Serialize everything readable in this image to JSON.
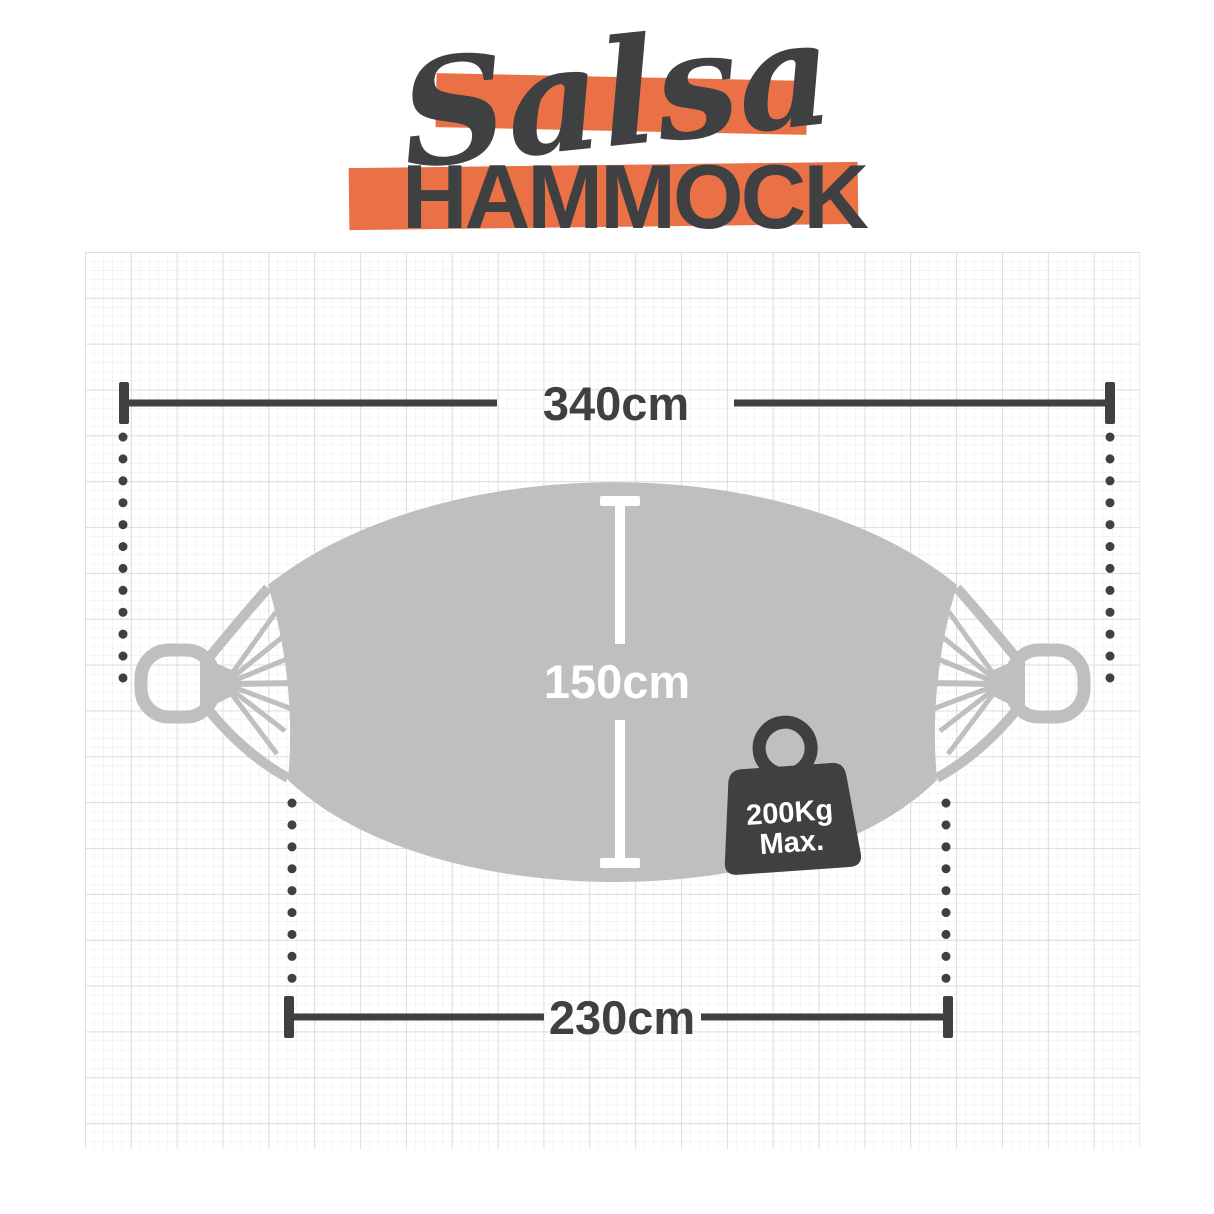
{
  "title": {
    "script": "Salsa",
    "main": "HAMMOCK"
  },
  "dimensions": {
    "total_length": "340cm",
    "width": "150cm",
    "bed_length": "230cm"
  },
  "weight_limit": {
    "line1": "200Kg",
    "line2": "Max."
  },
  "colors": {
    "accent_orange": "#EA7146",
    "charcoal": "#3E4042",
    "hammock_gray": "#BFBFBF",
    "grid_fine": "#EAEAEA",
    "grid_major": "#DADADA"
  }
}
